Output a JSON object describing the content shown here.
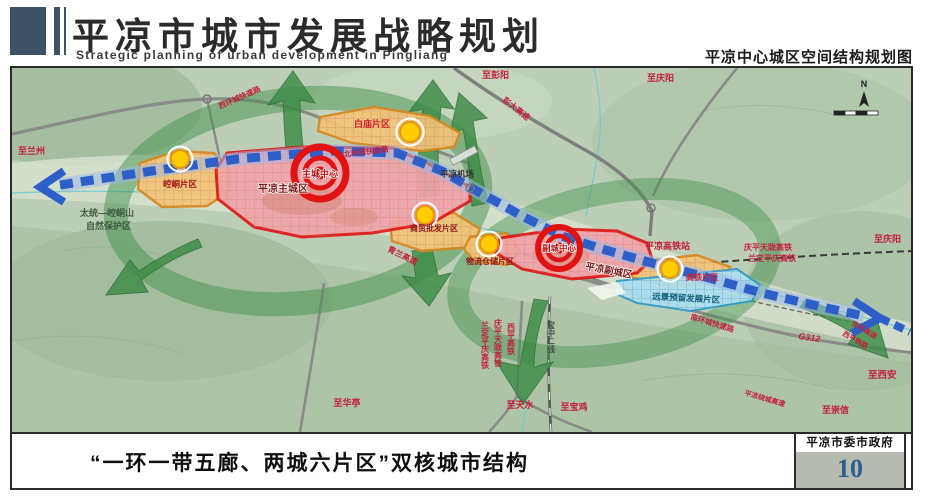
{
  "header": {
    "title": "平凉市城市发展战略规划",
    "subtitle_en": "Strategic planning of urban development in Pingliang",
    "map_title": "平凉中心城区空间结构规划图"
  },
  "footer": {
    "caption": "“一环一带五廊、两城六片区”双核城市结构",
    "authority": "平凉市委市政府",
    "page_number": "10"
  },
  "map": {
    "colors": {
      "terrain_base": "#bccfb6",
      "corridor_green": "#3c8c46",
      "axis_blue": "#2e5fc9",
      "core_red": "#e01212",
      "district_orange": "#f3c377",
      "reserved_blue": "#ade0ef",
      "road_label_red": "#c41e3a"
    },
    "labels": {
      "to_lanzhou": "至兰州",
      "to_pengyang": "至彭阳",
      "to_qingyang_top": "至庆阳",
      "to_qingyang_east": "至庆阳",
      "to_xian": "至西安",
      "to_chongxin": "至崇信",
      "to_tianshui": "至天水",
      "to_baoji": "至宝鸡",
      "to_huating": "至华亭",
      "nature_reserve_1": "太统—崆峒山",
      "nature_reserve_2": "自然保护区",
      "west_ring": "西环城快速路",
      "north_ring": "北环城快速路",
      "south_ring": "南环城快速路",
      "pengda_expwy": "彭大高速",
      "qinglan_expwy": "青兰高速",
      "jingping_expwy": "泾平高速",
      "xiping_railway": "西平铁路",
      "raocheng_expwy": "平凉绕城高速",
      "g312": "G312",
      "airport": "平凉机场",
      "hsr_station": "平凉高铁站",
      "qptl_hsr": "庆平天陇高铁",
      "ldpq_hsr": "兰定平庆高铁",
      "xiping_hsr": "西平高铁",
      "baozhong_line": "宝中二线",
      "main_city": "平凉主城区",
      "sub_city": "平凉副城区",
      "main_center": "主城中心",
      "sub_center": "副城中心",
      "kongtong_district": "崆峒片区",
      "baimiao_district": "白庙片区",
      "shangmao_district": "商贸批发片区",
      "wuliu_district": "物流仓储片区",
      "gaotie_district": "高铁片区",
      "reserved_district": "远景预留发展片区",
      "compass_n": "N"
    }
  }
}
